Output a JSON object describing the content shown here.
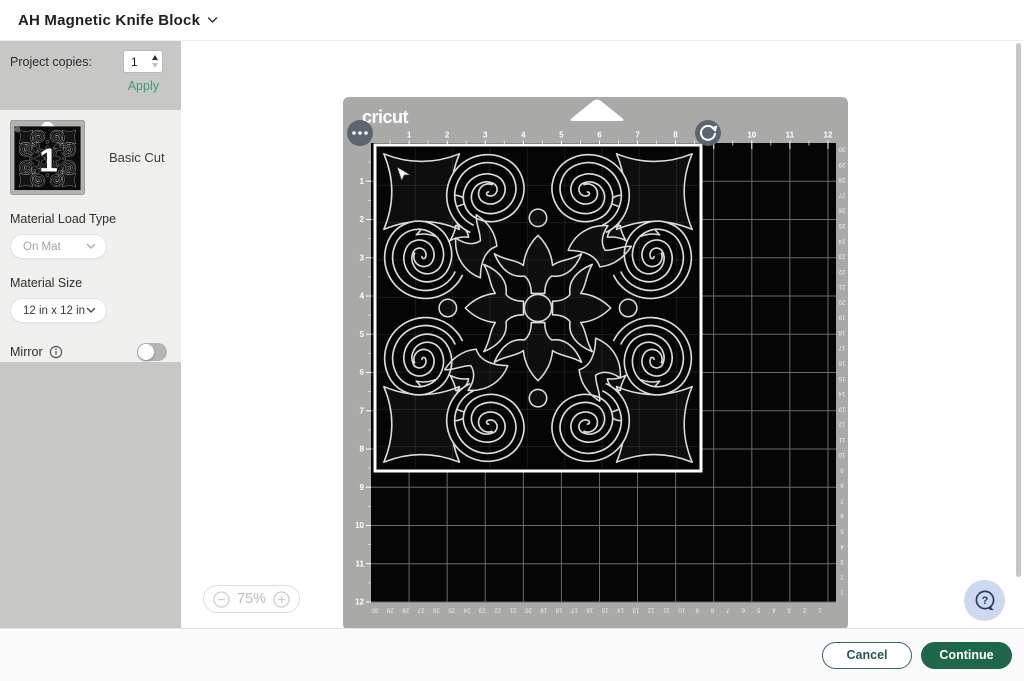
{
  "header": {
    "title": "AH Magnetic Knife Block"
  },
  "sidebar": {
    "project_copies": {
      "label": "Project copies:",
      "value": "1",
      "apply_label": "Apply"
    },
    "mat_card": {
      "badge": "1",
      "cut_type": "Basic Cut"
    },
    "material_load": {
      "label": "Material Load Type",
      "value": "On Mat"
    },
    "material_size": {
      "label": "Material Size",
      "value": "12 in x 12 in"
    },
    "mirror": {
      "label": "Mirror",
      "enabled": false
    }
  },
  "canvas": {
    "mat": {
      "brand": "cricut",
      "inch_ruler_max": 12,
      "cm_ruler_max": 30
    },
    "zoom": {
      "level": "75%"
    }
  },
  "footer": {
    "cancel": "Cancel",
    "continue": "Continue"
  },
  "colors": {
    "accent_green": "#1e684a",
    "link_green": "#3f9e6e",
    "mat_gray": "#a9a9a7",
    "mat_black": "#050505",
    "help_blue": "#cdd9f0",
    "sidebar_gray": "#c7c7c5",
    "panel_light": "#f0f0ee"
  }
}
